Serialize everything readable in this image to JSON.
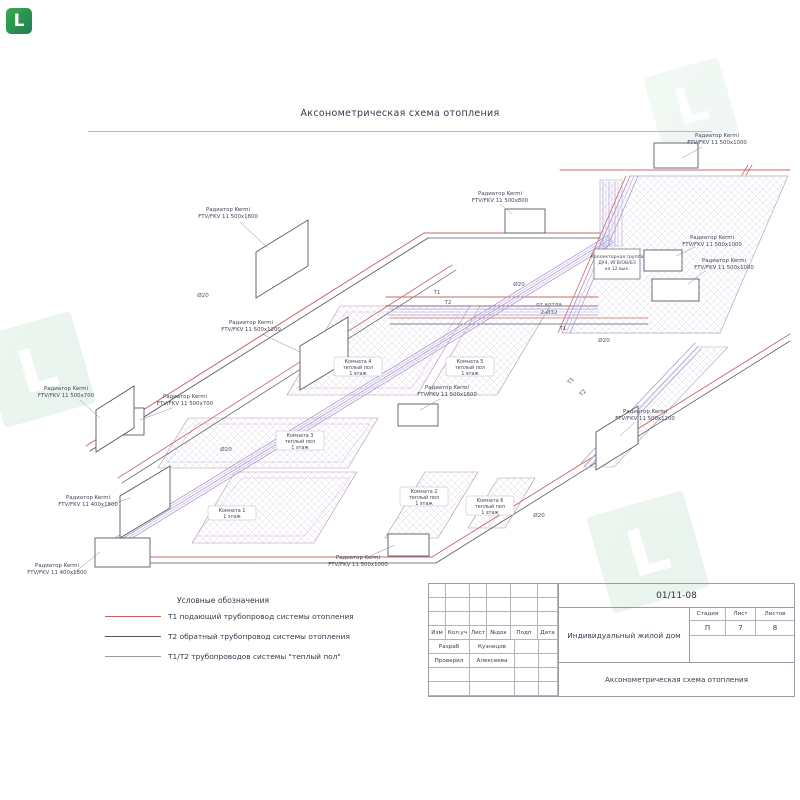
{
  "title": "Аксонометрическая схема отопления",
  "watermark": {
    "letter": "L",
    "color": "#2e9e44"
  },
  "radiators": [
    {
      "name": "Радиатор Kermi",
      "model": "FTV/FKV 11 500x1000"
    },
    {
      "name": "Радиатор Kermi",
      "model": "FTV/FKV 11 500x1800"
    },
    {
      "name": "Радиатор Kermi",
      "model": "FTV/FKV 11 500x1200"
    },
    {
      "name": "Радиатор Kermi",
      "model": "FTV/FKV 11 500x700"
    },
    {
      "name": "Радиатор Kermi",
      "model": "FTV/FKV 11 500x700"
    },
    {
      "name": "Радиатор Kermi",
      "model": "FTV/FKV 11 400x1800"
    },
    {
      "name": "Радиатор Kermi",
      "model": "FTV/FKV 11 400x1800"
    },
    {
      "name": "Радиатор Kermi",
      "model": "FTV/FKV 11 500x1000"
    },
    {
      "name": "Радиатор Kermi",
      "model": "FTV/FKV 11 500x1600"
    },
    {
      "name": "Радиатор Kermi",
      "model": "FTV/FKV 11 500x800"
    },
    {
      "name": "Радиатор Kermi",
      "model": "FTV/FKV 11 500x1000"
    },
    {
      "name": "Радиатор Kermi",
      "model": "FTV/FKV 11 500x1000"
    },
    {
      "name": "Радиатор Kermi",
      "model": "FTV/FKV 11 500x1200"
    }
  ],
  "rooms": [
    {
      "l1": "Комната 4",
      "l2": "теплый пол",
      "l3": "1 этаж"
    },
    {
      "l1": "Комната 5",
      "l2": "теплый пол",
      "l3": "1 этаж"
    },
    {
      "l1": "Комната 3",
      "l2": "теплый пол",
      "l3": "1 этаж"
    },
    {
      "l1": "Комната 1",
      "l2": "1 этаж",
      "l3": ""
    },
    {
      "l1": "Комната 2",
      "l2": "теплый пол",
      "l3": "1 этаж"
    },
    {
      "l1": "Комната 6",
      "l2": "теплый пол",
      "l3": "1 этаж"
    }
  ],
  "collector": {
    "l1": "Коллекторная группа",
    "l2": "ДУ4, ИГВ/ОВ/БЗ",
    "l3": "на 12 вых."
  },
  "pipes": {
    "d20": "Ø20",
    "from_boiler": "от котла",
    "d32": "2-Ø32",
    "t1": "Т1",
    "t2": "Т2"
  },
  "legend": {
    "title": "Условные обозначения",
    "items": [
      {
        "label": "Т1 подающий трубопровод системы отопления",
        "color": "#c06060"
      },
      {
        "label": "Т2 обратный трубопровод системы отопления",
        "color": "#55555f"
      },
      {
        "label": "Т1/Т2 трубопроводов системы \"теплый пол\"",
        "color": "#9a9aa4"
      }
    ]
  },
  "titleblock": {
    "doc_no": "01/11-08",
    "cols": [
      "Изм",
      "Кол.уч",
      "Лист",
      "№док",
      "Подп",
      "Дата"
    ],
    "rows": [
      {
        "role": "Разраб",
        "name": "Кузнецов"
      },
      {
        "role": "Проверил",
        "name": "Алексеева"
      }
    ],
    "project": "Индивидуальный жилой дом",
    "stage_h": "Стадия",
    "sheet_h": "Лист",
    "sheets_h": "Листов",
    "stage": "П",
    "sheet": "7",
    "sheets": "8",
    "sheet_title": "Аксонометрическая схема отопления"
  }
}
